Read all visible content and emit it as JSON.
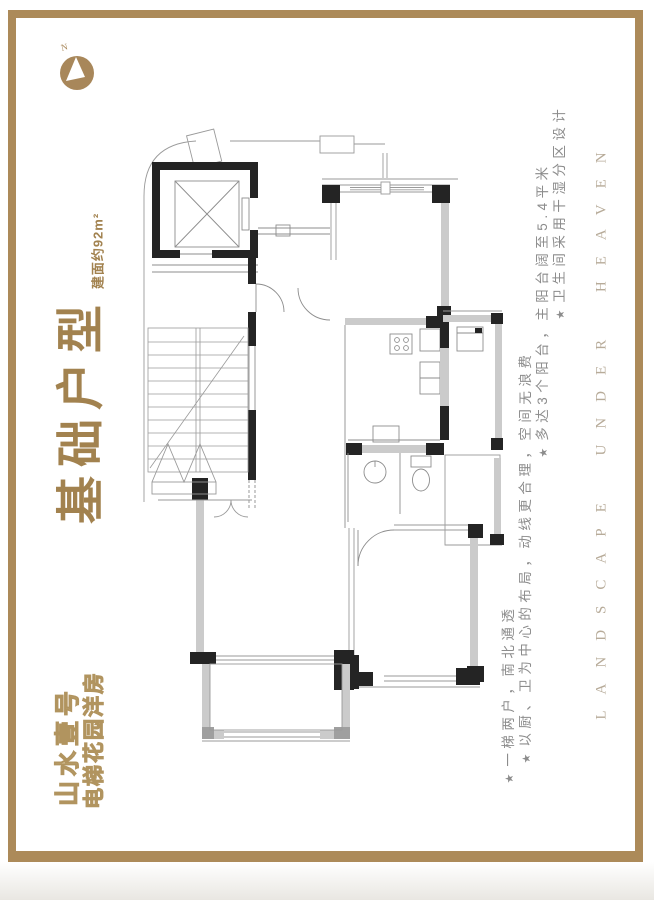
{
  "colors": {
    "frame_gold": "#ac8a59",
    "title_gold": "#a2824f",
    "brand_gold": "#b1945f",
    "bullet_gray": "#8c8c8c",
    "caption_gray": "#b7ab99",
    "wall_black": "#242424",
    "wall_gray": "#cbcbcb"
  },
  "compass": {
    "label": "N"
  },
  "left_panel": {
    "title": "基础户型",
    "area_note": "建面约92m²",
    "brand_name": "山水壹号",
    "brand_tagline": "电梯花园洋房"
  },
  "selling_points": {
    "bullet_icon": "★",
    "items": [
      {
        "text": "一梯两户，南北通透"
      },
      {
        "text": "以厨、卫为中心的布局，动线更合理，空间无浪费"
      },
      {
        "text": "多达3个阳台，主阳台阔至5.4平米"
      },
      {
        "text": "卫生间采用干湿分区设计"
      }
    ]
  },
  "side_caption": "LANDSCAPE UNDER HEAVEN",
  "floor_plan": {
    "features": [
      "elevator",
      "stairs",
      "entry-porch",
      "living-room",
      "bedroom-north",
      "bedroom-south",
      "kitchen",
      "bathroom",
      "service-balcony",
      "side-balcony",
      "south-balcony"
    ]
  }
}
